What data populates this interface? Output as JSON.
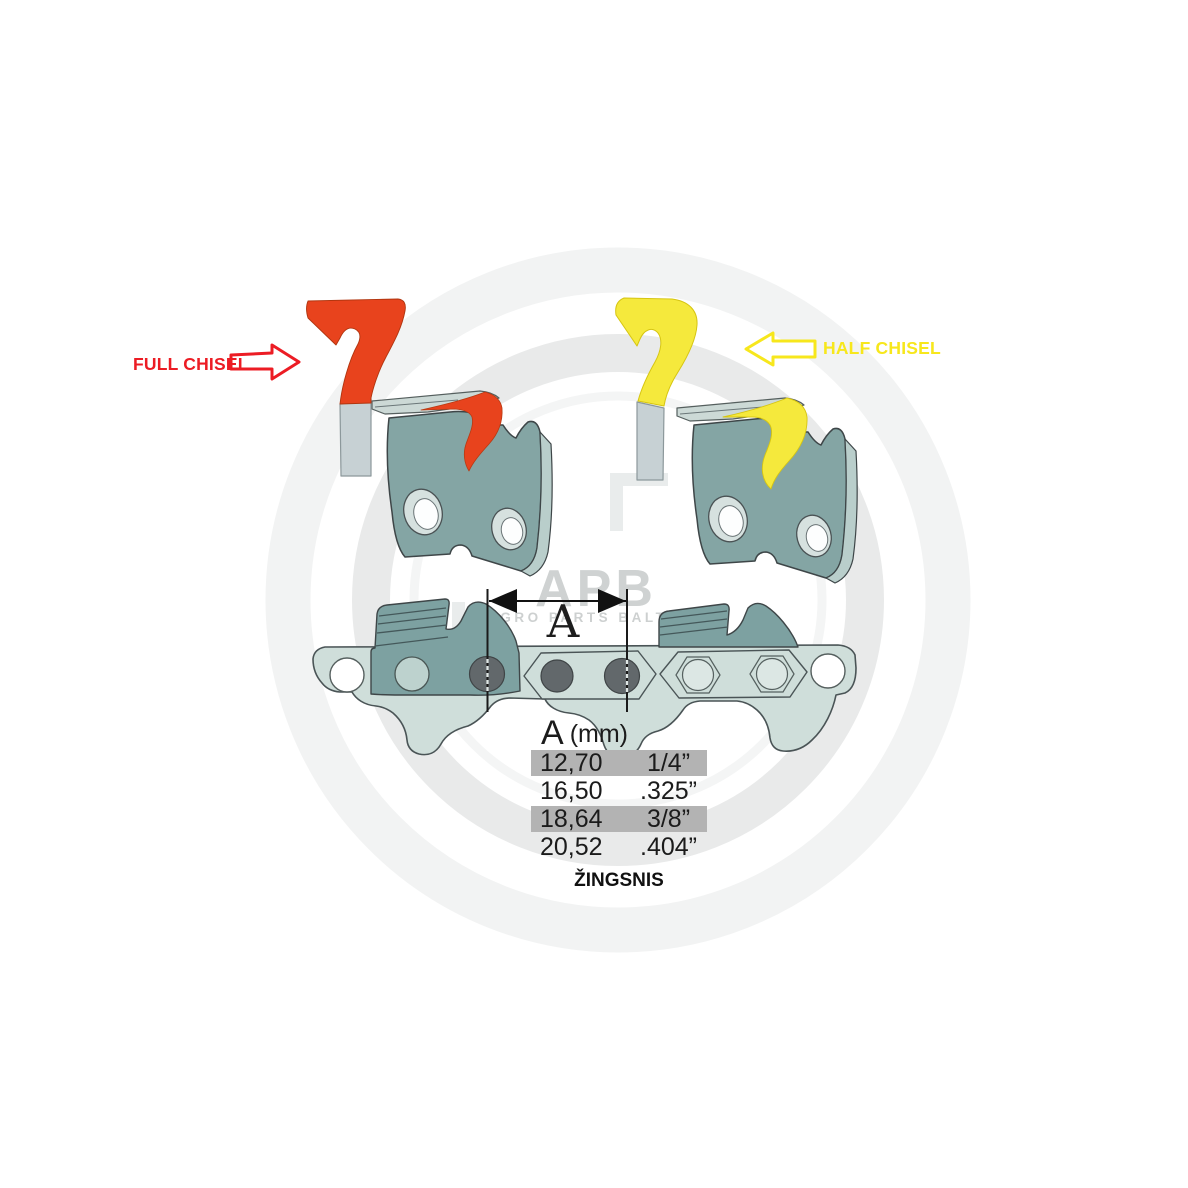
{
  "labels": {
    "full_chisel": "FULL CHISEL",
    "half_chisel": "HALF CHISEL",
    "dimension_letter": "A",
    "pitch_caption": "ŽINGSNIS"
  },
  "table": {
    "header": {
      "letter": "A",
      "unit": "(mm)"
    },
    "columns": [
      "pitch_mm",
      "pitch_inch"
    ],
    "rows": [
      {
        "mm": "12,70",
        "inch": "1/4”",
        "highlighted": true
      },
      {
        "mm": "16,50",
        "inch": ".325”",
        "highlighted": false
      },
      {
        "mm": "18,64",
        "inch": "3/8”",
        "highlighted": true
      },
      {
        "mm": "20,52",
        "inch": ".404”",
        "highlighted": false
      }
    ]
  },
  "watermark": {
    "brand": "APB",
    "subtitle": "AGRO PARTS BALTIJA"
  },
  "colors": {
    "full_chisel_red": "#e8431d",
    "full_chisel_label_red": "#ec1c24",
    "half_chisel_yellow": "#f5e93c",
    "half_chisel_label_yellow": "#f7e71c",
    "link_body_teal": "#84a5a4",
    "link_side_teal": "#b9cecb",
    "top_plate_teal": "#ccd9d6",
    "chain_strip_light": "#cfdeda",
    "strip_cutter_dark": "#7da1a1",
    "rivet_gray": "#62686b",
    "shank_gray": "#c7d1d4",
    "table_row_gray": "#b3b3b3",
    "watermark_gray": "#cfd2d2",
    "text_black": "#1a1a1a"
  }
}
